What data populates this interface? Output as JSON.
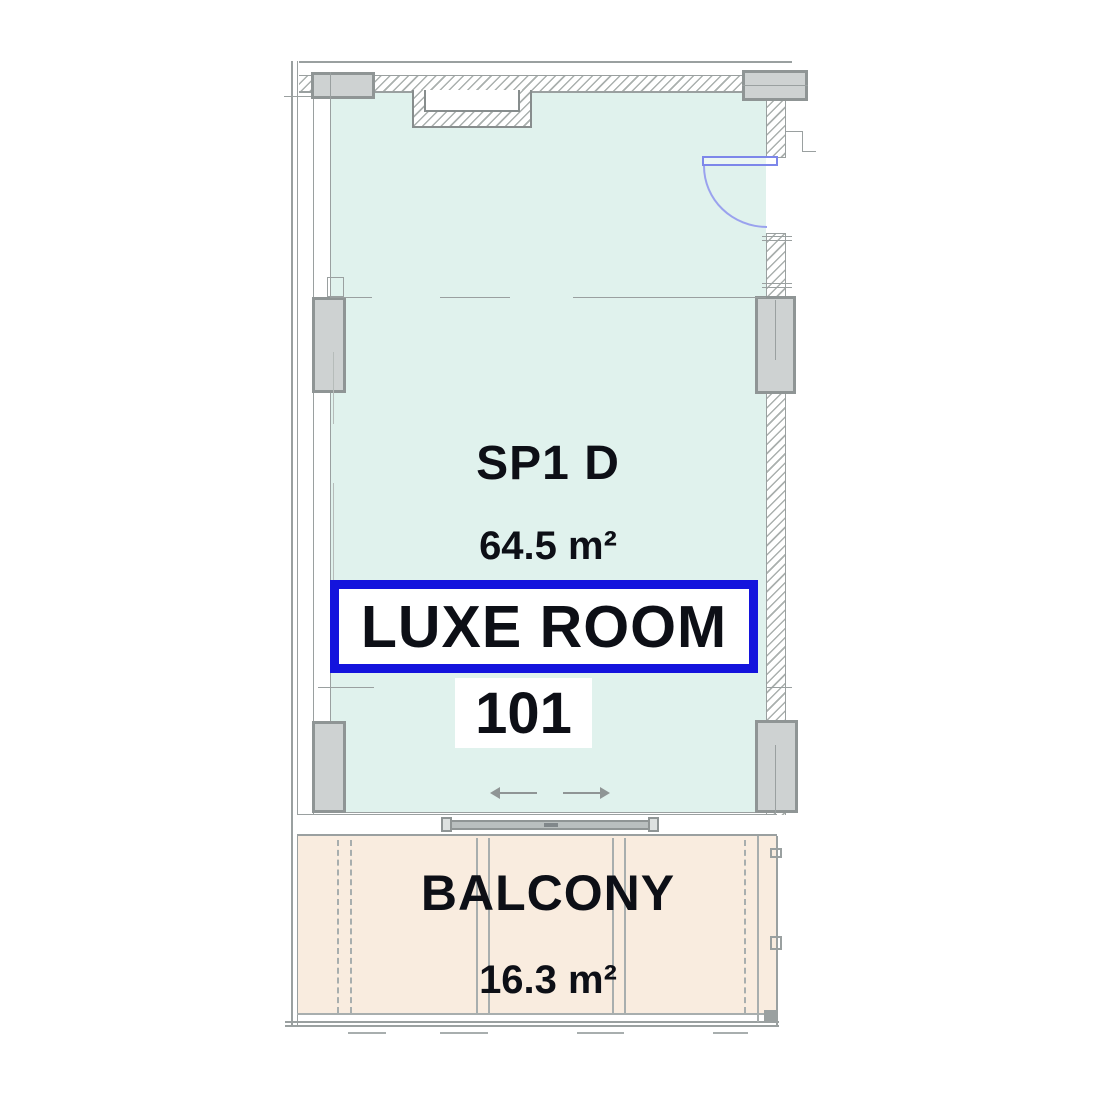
{
  "room": {
    "type_code": "SP1 D",
    "area": "64.5 m²",
    "name": "LUXE ROOM",
    "number": "101"
  },
  "balcony": {
    "name": "BALCONY",
    "area": "16.3 m²"
  },
  "colors": {
    "room_fill": "#e0f2ed",
    "balcony_fill": "#f9ecdf",
    "highlight_border_blue": "#1414dd",
    "door_swing_blue": "#8d95ec",
    "wall_line_gray": "#9aa0a0",
    "pillar_fill": "#ced2d2",
    "label_text": "#0d0f16"
  },
  "icons": {
    "door_swing": "door-swing-arc-icon",
    "slide_left": "arrow-left-icon",
    "slide_right": "arrow-right-icon"
  }
}
